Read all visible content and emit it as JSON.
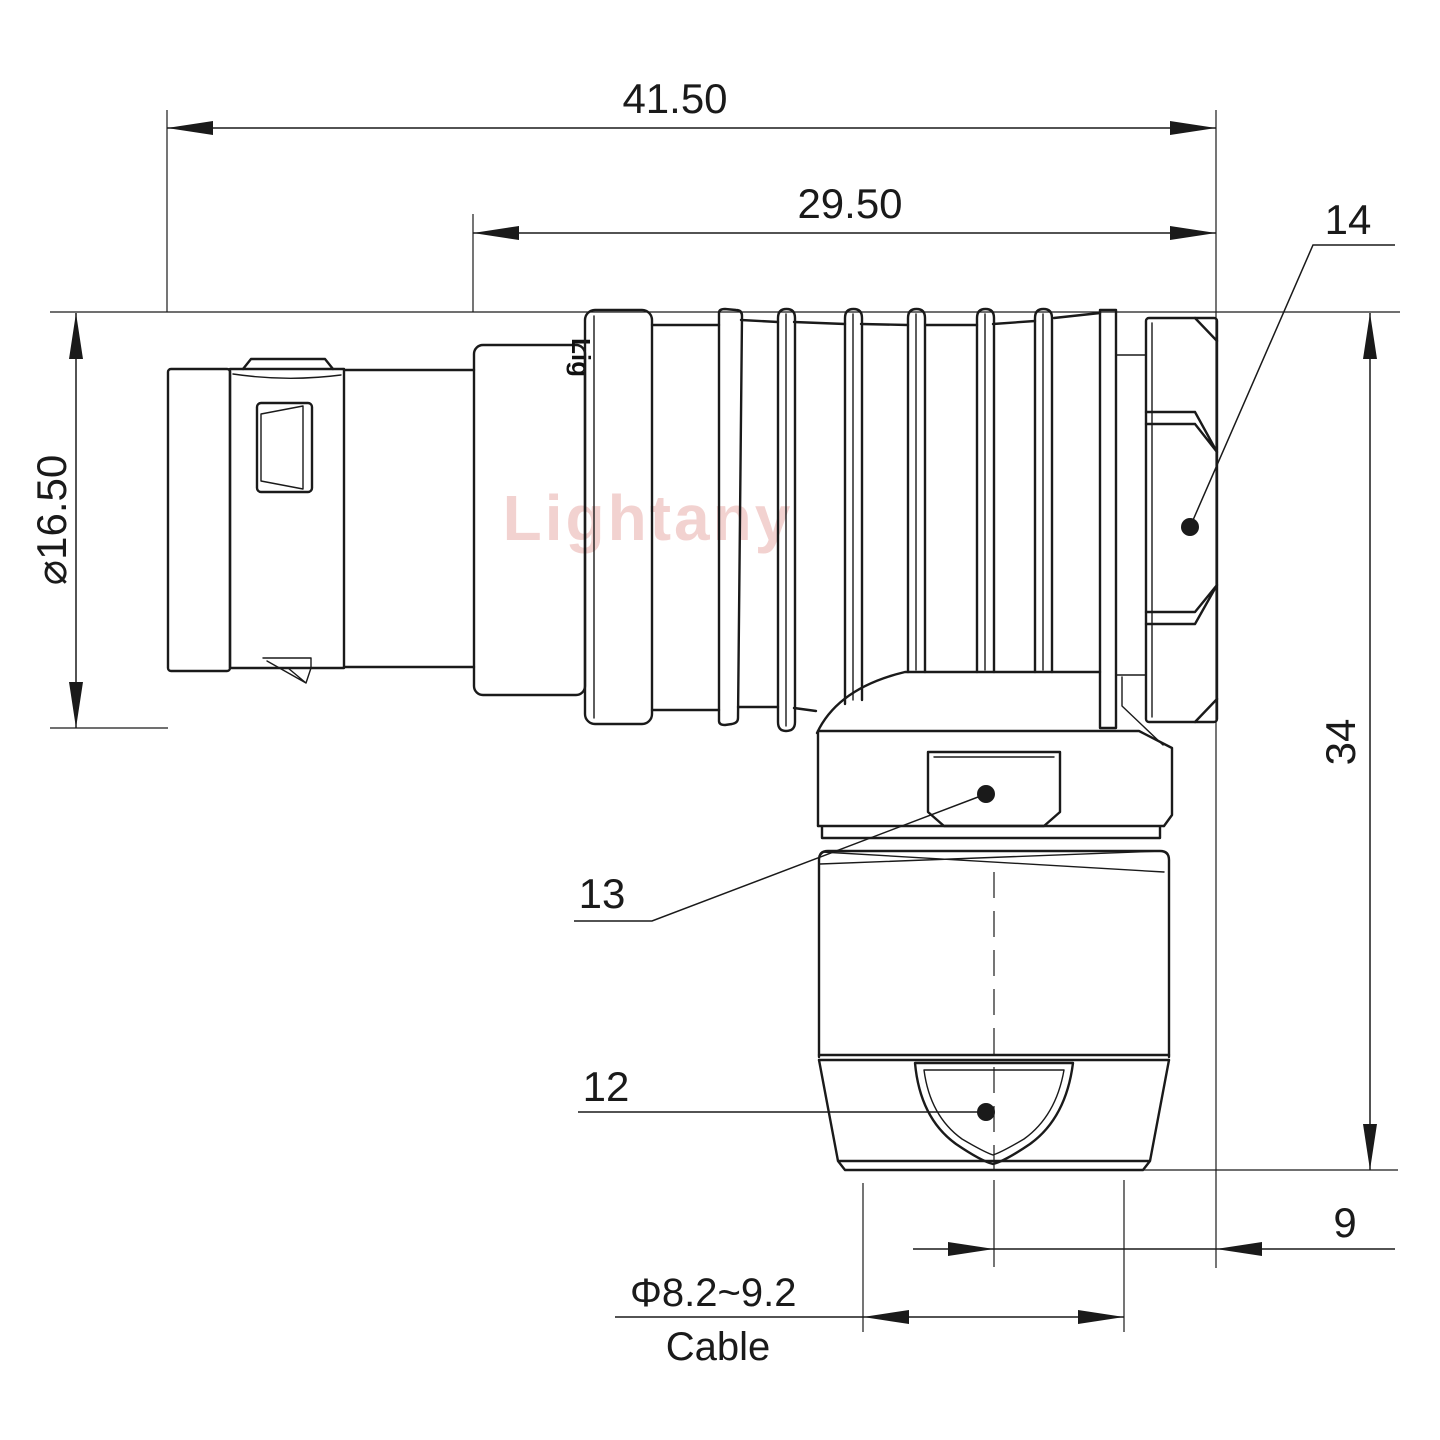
{
  "page": {
    "background": "#ffffff"
  },
  "drawing": {
    "watermark": {
      "text": "Lightany",
      "color": "#e49c98"
    },
    "part_marking": "Lig",
    "colors": {
      "line": "#1a1a1a",
      "background": "#ffffff"
    },
    "dimensions": {
      "overall_length": {
        "value": "41.50"
      },
      "rear_length": {
        "value": "29.50"
      },
      "shell_diameter": {
        "value": "⌀16.50"
      },
      "height": {
        "value": "34"
      },
      "exit_offset": {
        "value": "9"
      },
      "cable_diameter_range": {
        "value": "Φ8.2~9.2"
      },
      "cable_label": {
        "value": "Cable"
      }
    },
    "callouts": [
      {
        "id": "14",
        "part": "coupling-nut-hex"
      },
      {
        "id": "13",
        "part": "elbow-body-hex"
      },
      {
        "id": "12",
        "part": "cable-gland-window"
      }
    ]
  }
}
